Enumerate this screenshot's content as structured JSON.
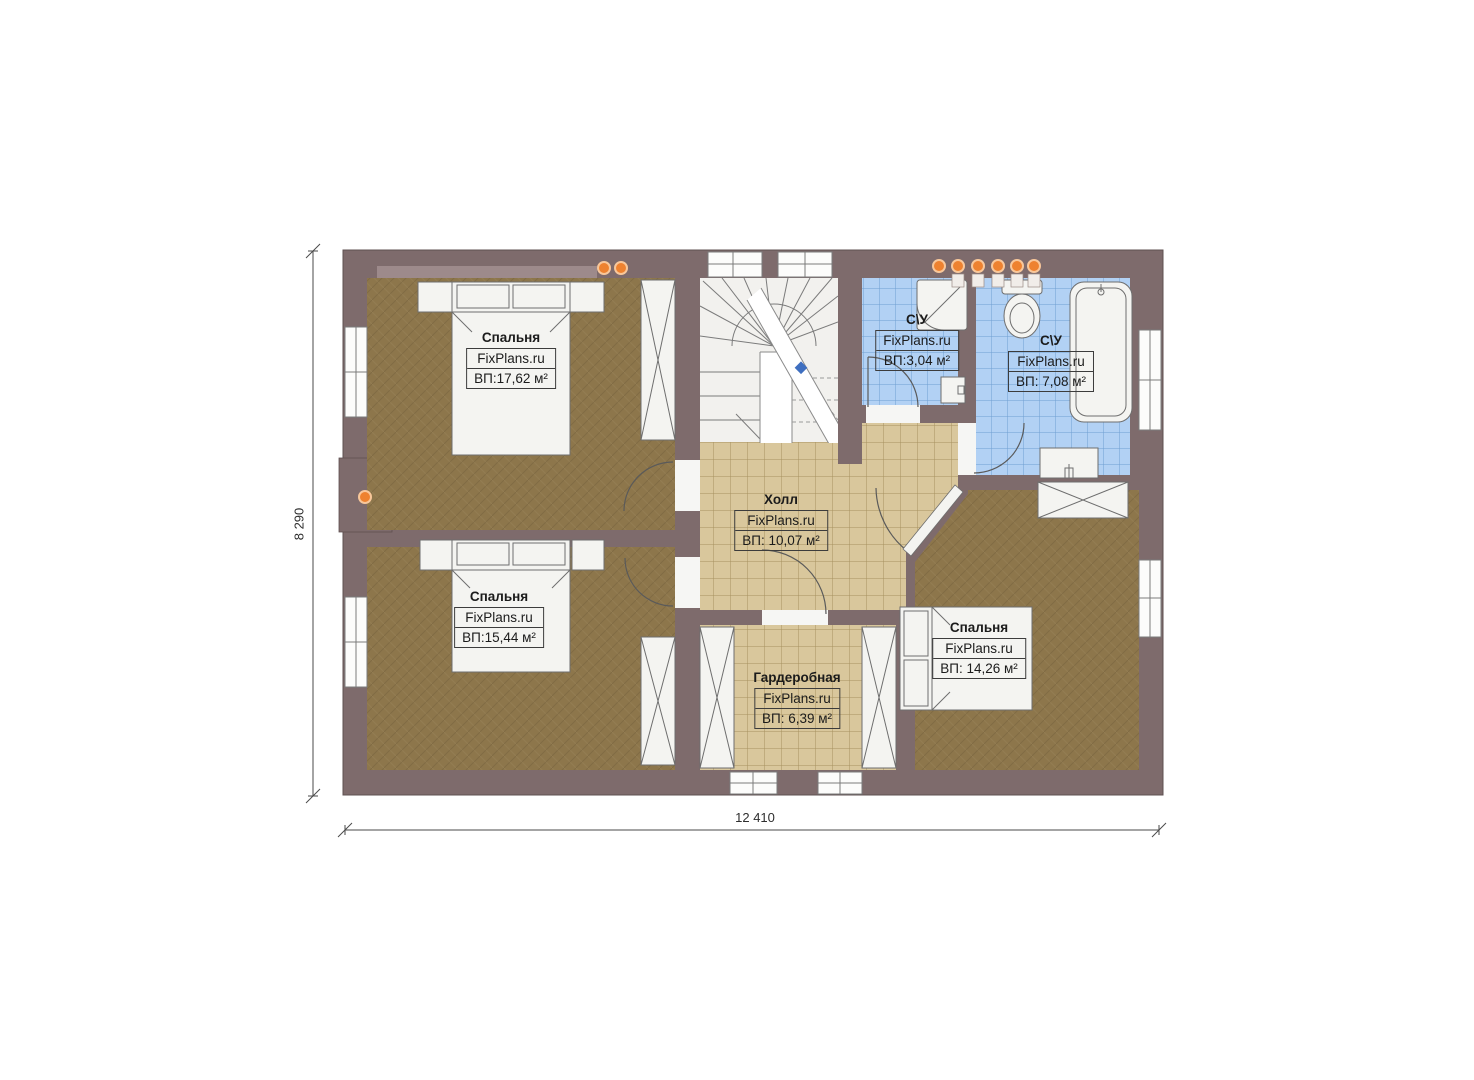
{
  "plan": {
    "rooms": [
      {
        "name": "Спальня",
        "site": "FixPlans.ru",
        "area": "ВП:17,62 м²"
      },
      {
        "name": "Спальня",
        "site": "FixPlans.ru",
        "area": "ВП:15,44 м²"
      },
      {
        "name": "Холл",
        "site": "FixPlans.ru",
        "area": "ВП: 10,07 м²"
      },
      {
        "name": "Гардеробная",
        "site": "FixPlans.ru",
        "area": "ВП: 6,39 м²"
      },
      {
        "name": "С\\У",
        "site": "FixPlans.ru",
        "area": "ВП:3,04 м²"
      },
      {
        "name": "С\\У",
        "site": "FixPlans.ru",
        "area": "ВП: 7,08 м²"
      },
      {
        "name": "Спальня",
        "site": "FixPlans.ru",
        "area": "ВП: 14,26 м²"
      }
    ],
    "dimensions": {
      "width": "12 410",
      "height": "8 290"
    },
    "colors": {
      "wall": "#7e6b6c",
      "wall_niche": "#9d8a8b",
      "bedroom_floor": "#8d764b",
      "tile_floor": "#d9c79c",
      "bath_floor": "#b2d1f4",
      "fixture_fill": "#f4f4f1",
      "accent_orange": "#ee8230",
      "marker_blue": "#3f6fc0"
    }
  }
}
